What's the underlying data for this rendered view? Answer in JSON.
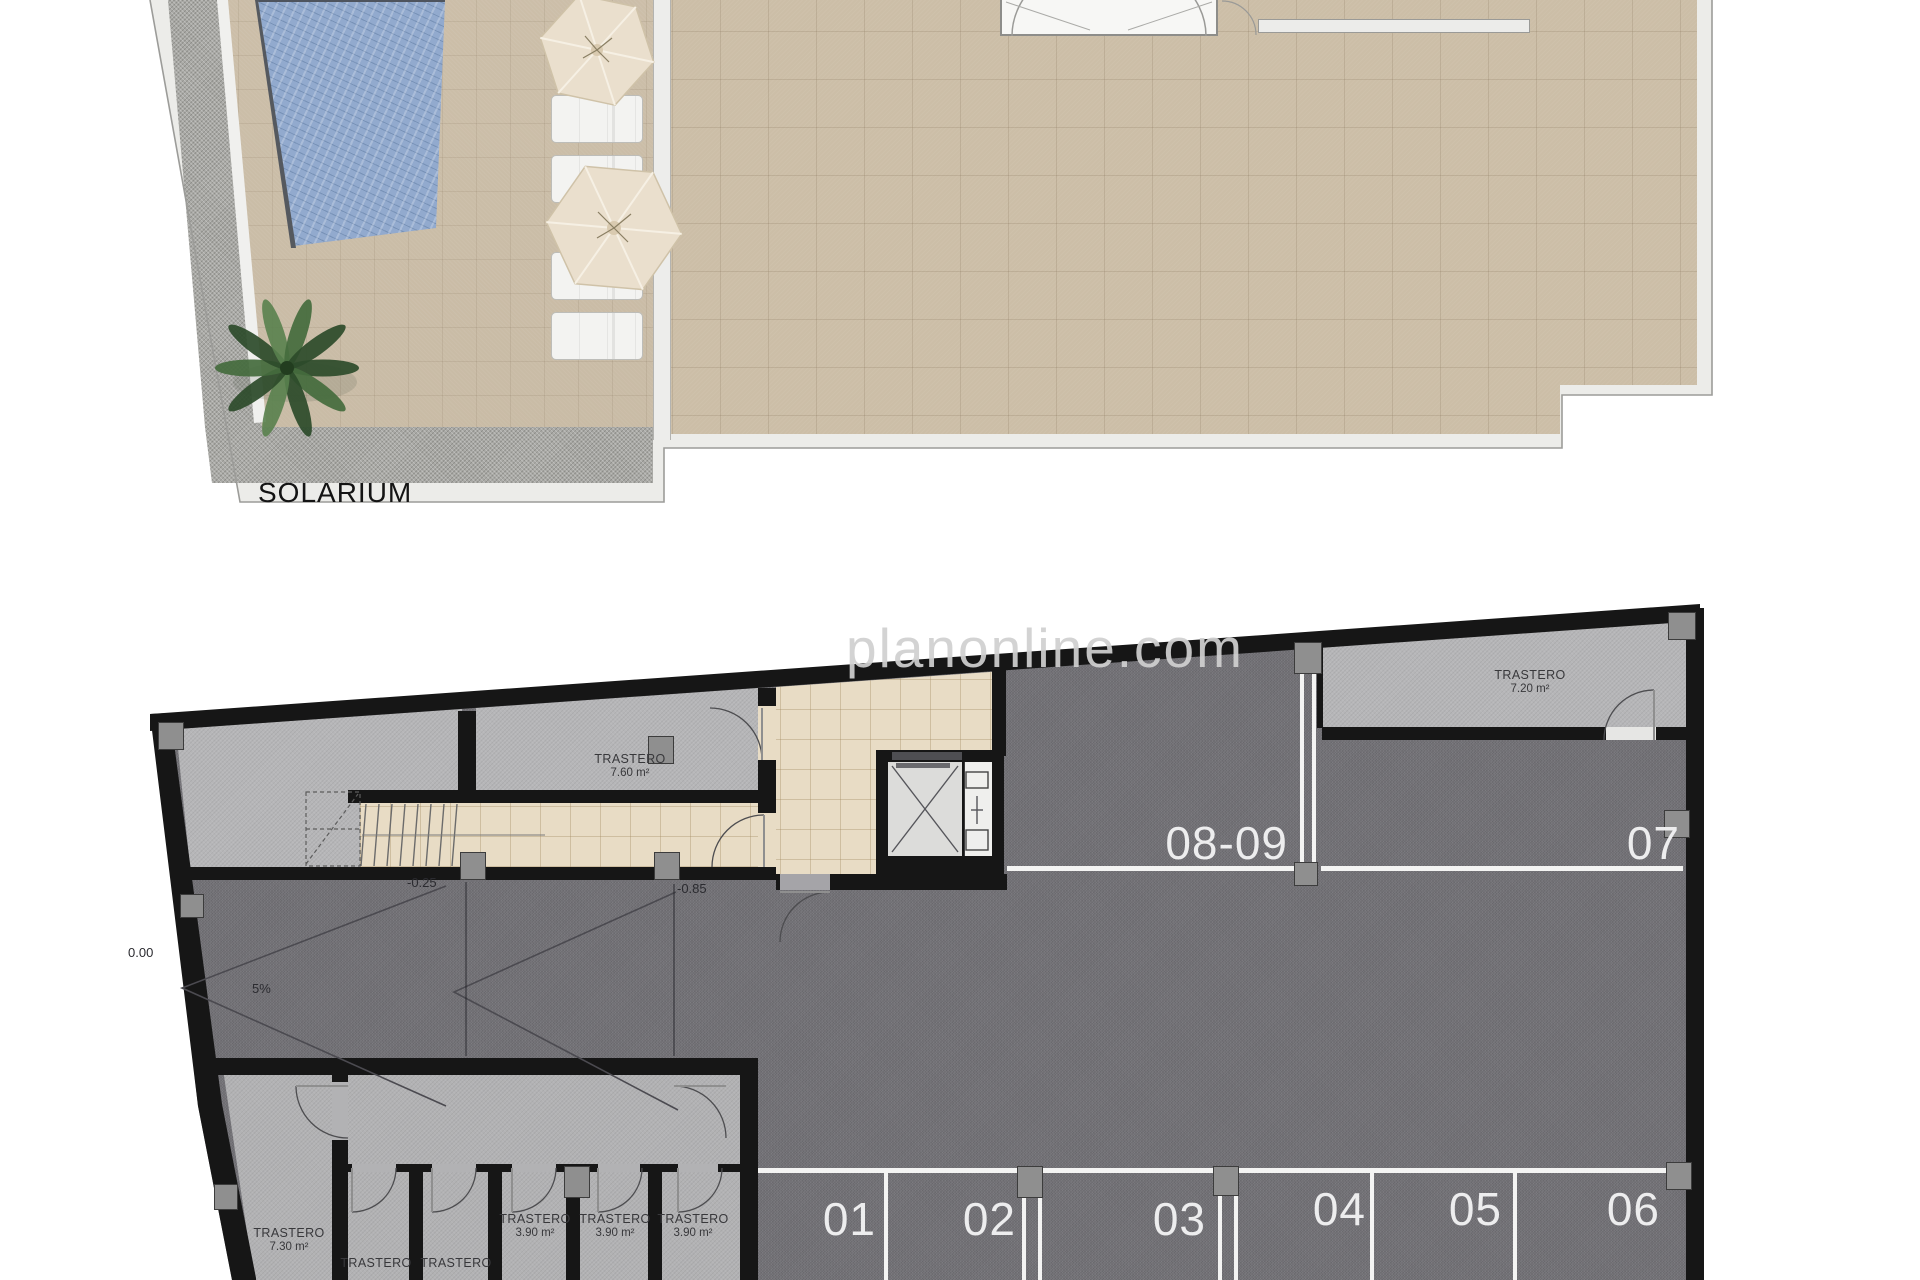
{
  "solarium": {
    "title": "SOLARIUM",
    "features": [
      "pool",
      "two-parasols",
      "four-sun-loungers",
      "palm-tree",
      "gravel-border",
      "tiled-roof-terrace",
      "stair-access"
    ]
  },
  "watermark": "planonline.com",
  "garage": {
    "storerooms": [
      {
        "name": "TRASTERO",
        "area": "7.60 m²"
      },
      {
        "name": "TRASTERO",
        "area": "7.20 m²"
      },
      {
        "name": "TRASTERO",
        "area": "7.30 m²"
      },
      {
        "name": "TRASTERO",
        "area": "3.90 m²"
      },
      {
        "name": "TRASTERO",
        "area": "3.90 m²"
      },
      {
        "name": "TRASTERO",
        "area": "3.90 m²"
      },
      {
        "name": "TRASTERO",
        "area": ""
      },
      {
        "name": "TRASTERO",
        "area": ""
      }
    ],
    "parking": [
      "01",
      "02",
      "03",
      "04",
      "05",
      "06",
      "07",
      "08-09"
    ],
    "levels": {
      "zero": "0.00",
      "grade": "5%",
      "l1": "-0.25",
      "l2": "-0.85"
    },
    "features": [
      "ramp",
      "stairs",
      "elevator",
      "parking-aisle"
    ]
  },
  "colors": {
    "pool_blue": "#92aace",
    "deck_tan": "#c9bba4",
    "terrace_tan": "#ccbea7",
    "gravel_gray": "#a9a9a5",
    "asphalt_gray": "#727176",
    "room_gray": "#b6b6b8",
    "corridor_beige": "#e8dcc5",
    "wall_black": "#161616",
    "parking_line_white": "#f4f4f3",
    "watermark_gray": "#d0d0d0"
  }
}
